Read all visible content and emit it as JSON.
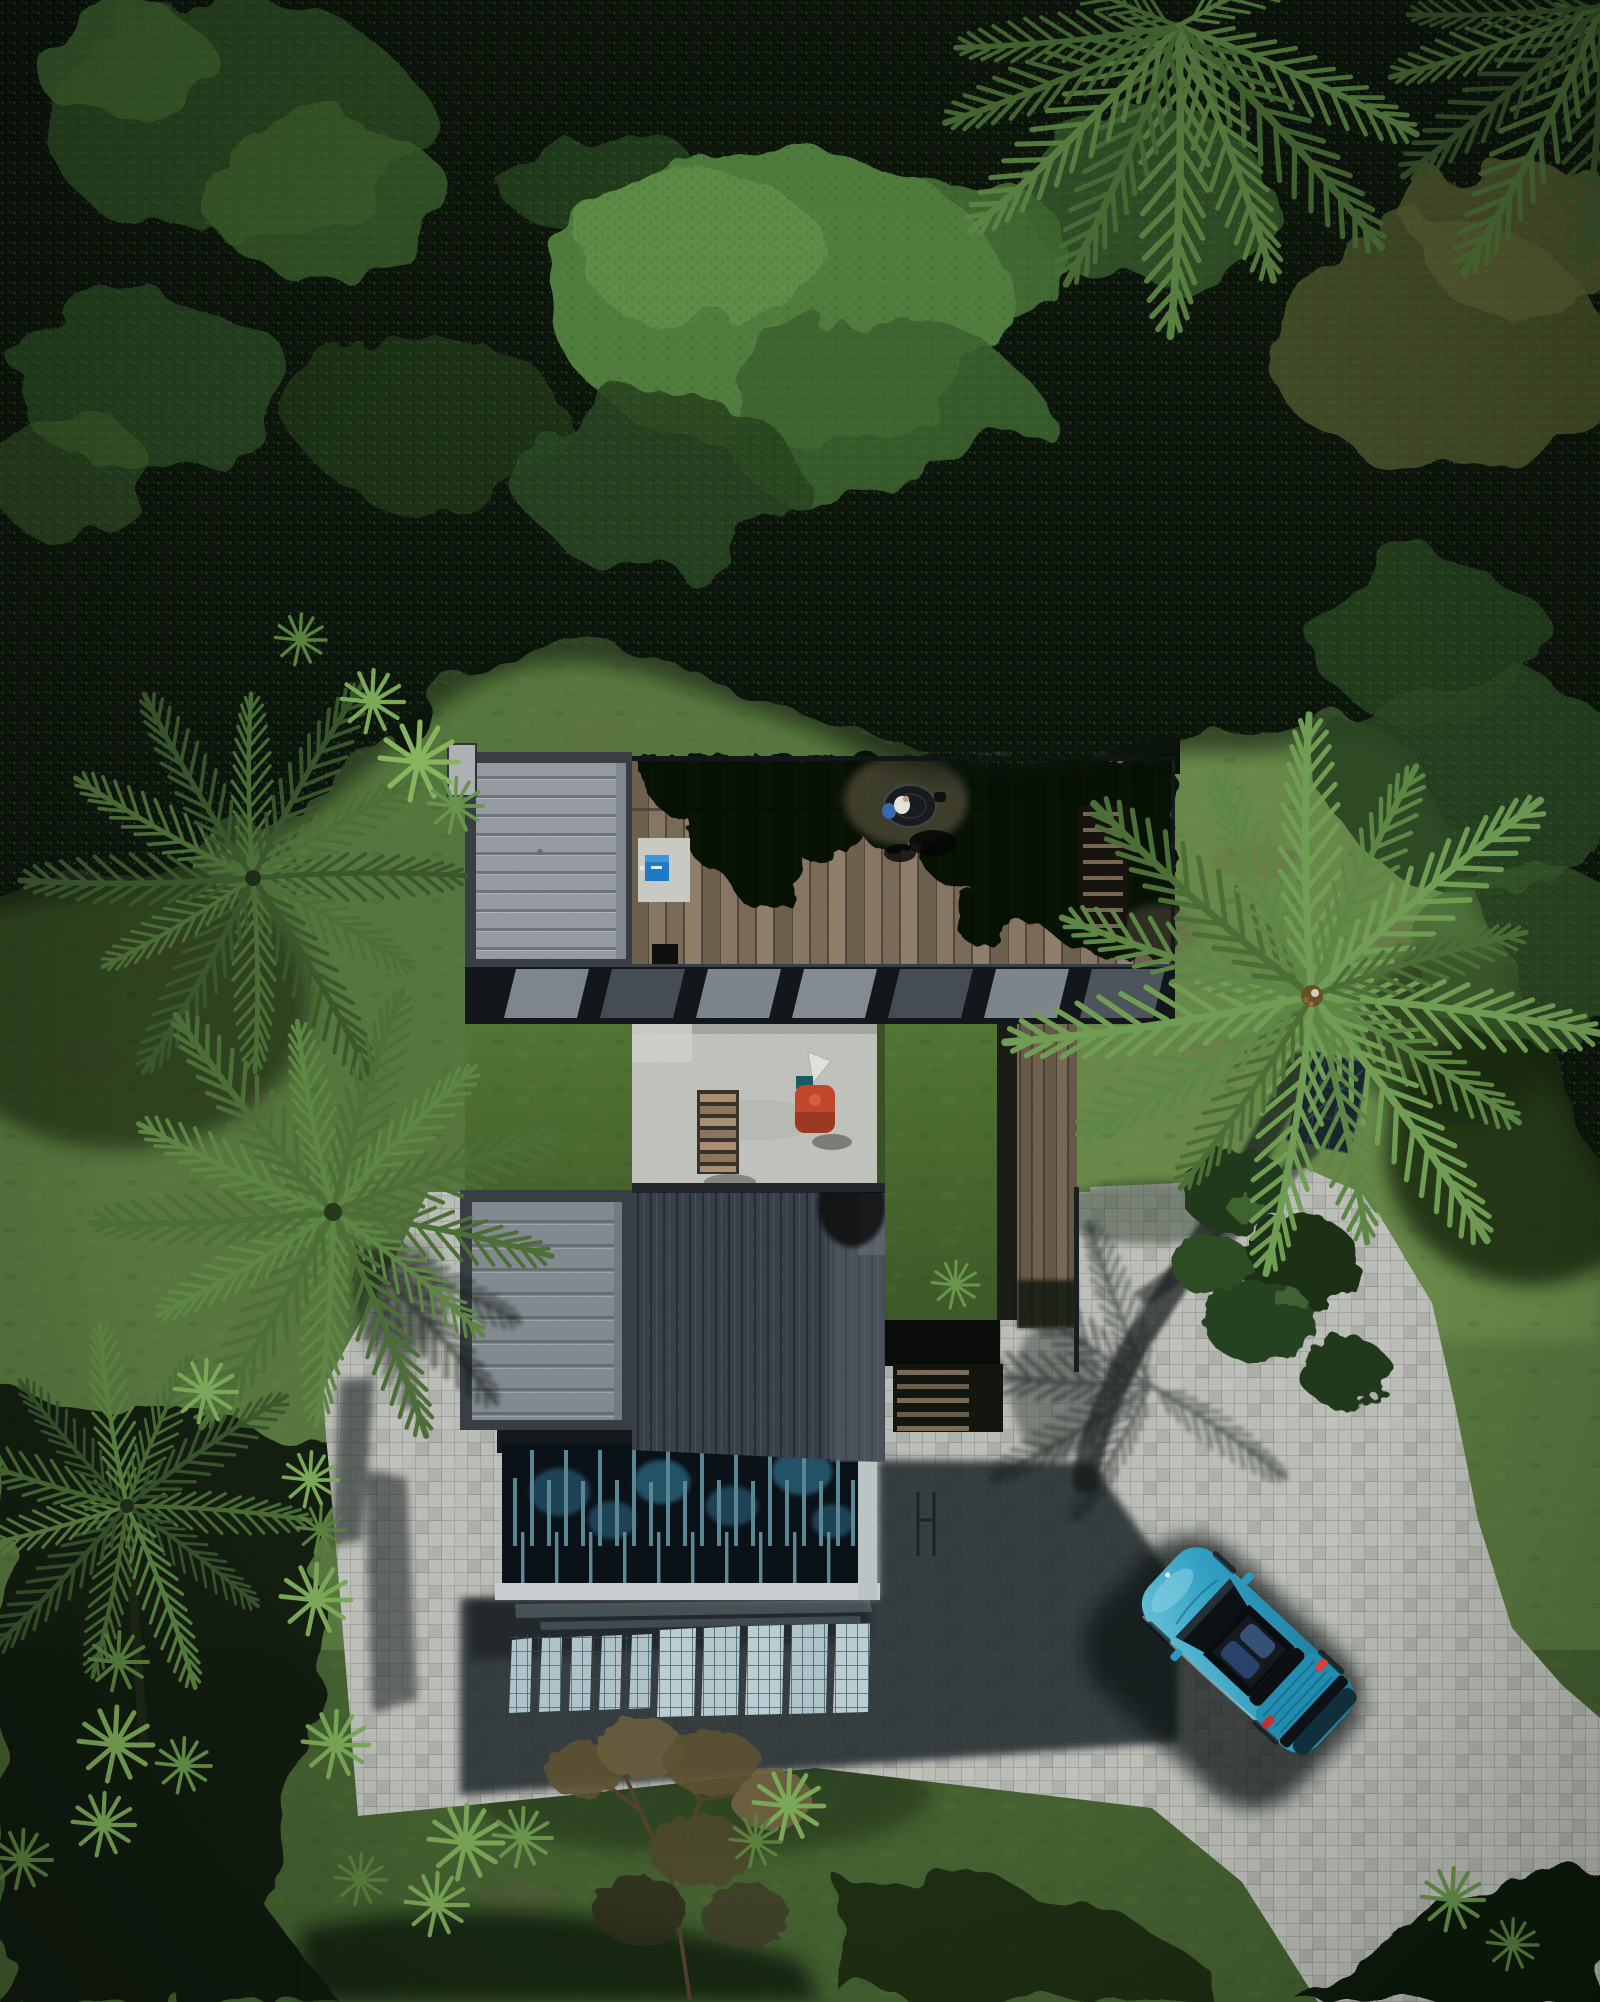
{
  "scene": {
    "title": "Aerial drone view of a modern jungle villa at midday",
    "labels": {
      "forest": "Tropical forest canopy",
      "lawn": "Lawn clearing",
      "driveway": "Cobblestone driveway and parking court",
      "house": "Modern flat-roof villa",
      "grayRoofTop": "Ribbed metal roof module (north)",
      "deck": "Rooftop timber deck",
      "deckTable": "Round table with seated person",
      "deckStairs": "Deck stairs",
      "clerestory": "Clerestory glazing band",
      "greenRoof": "Planted green roof",
      "patio": "Concrete roof patio",
      "loungeChair": "Timber lounge chair",
      "grill": "Red barbecue grill",
      "grayRoofLow": "Ribbed metal roof module (south-west)",
      "darkRoof": "Standing-seam dark metal roof",
      "louvers": "Louvered glass atrium over pool",
      "lightWell": "Daylight through glazing projected on pavers",
      "walkway": "Timber walkway",
      "lowerStairs": "Garden stairs",
      "car": "Teal sports car",
      "carShadow": "Car shadow",
      "palmLeftUpper": "Palm tree (north-west)",
      "palmLeftMid": "Palm tree (west)",
      "palmLeftLower": "Leaning palm tree (south-west)",
      "palmRight": "Palm tree (east)",
      "palmTop": "Palm tree (north)",
      "palmCorner": "Palm fronds (north-east corner)",
      "bushes": "Shrubs by the driveway",
      "solarPanel": "Dark panel on the lawn",
      "ferns": "Tree ferns",
      "dryTree": "Dry-leaved tree",
      "houseShadow": "Building shadow on pavement",
      "palmShadows": "Palm shadows on pavement"
    }
  },
  "colors": {
    "canopyBase": "#0b140c",
    "canopyMid": "#2a4621",
    "canopyBright": "#3f6530",
    "canopyLush": "#538240",
    "oliveTree": "#4a512c",
    "lawn": "#5b7b41",
    "lawnBright": "#6e9150",
    "lawnBottom": "#476432",
    "lawnShade": "#24391d",
    "paver": "#c1c3bd",
    "paverLine": "#989b94",
    "houseShadow": "#272d31",
    "glassLight": "#b7c9cf",
    "glassMullion": "#2c5260",
    "roofGrayPanel": "#9aa0a6",
    "roofGrayRib": "#71787e",
    "roofGray2": "#878e95",
    "roofFrame": "#3a4046",
    "roofDark": "#3a424c",
    "greenRoof": "#4a682f",
    "patio": "#c6c8c2",
    "louverDark": "#0c1318",
    "louverSlat": "#5e8b99",
    "louverHex": "#265671",
    "louverFrame": "#ced4d5",
    "deckShadow": "#060705",
    "carTeal": "#35a7ca",
    "carTealDark": "#1f7ea3",
    "carGlass": "#0d1217",
    "carRed": "#d03636",
    "grillRed": "#c84a2e",
    "chairWood": "#b09577",
    "boxBlue": "#1f7dcd",
    "palmA": "#4f7339",
    "palmB": "#618b47",
    "palmC": "#74a257",
    "palmDark": "#3c5a2f",
    "fernBright": "#7fae5b"
  }
}
